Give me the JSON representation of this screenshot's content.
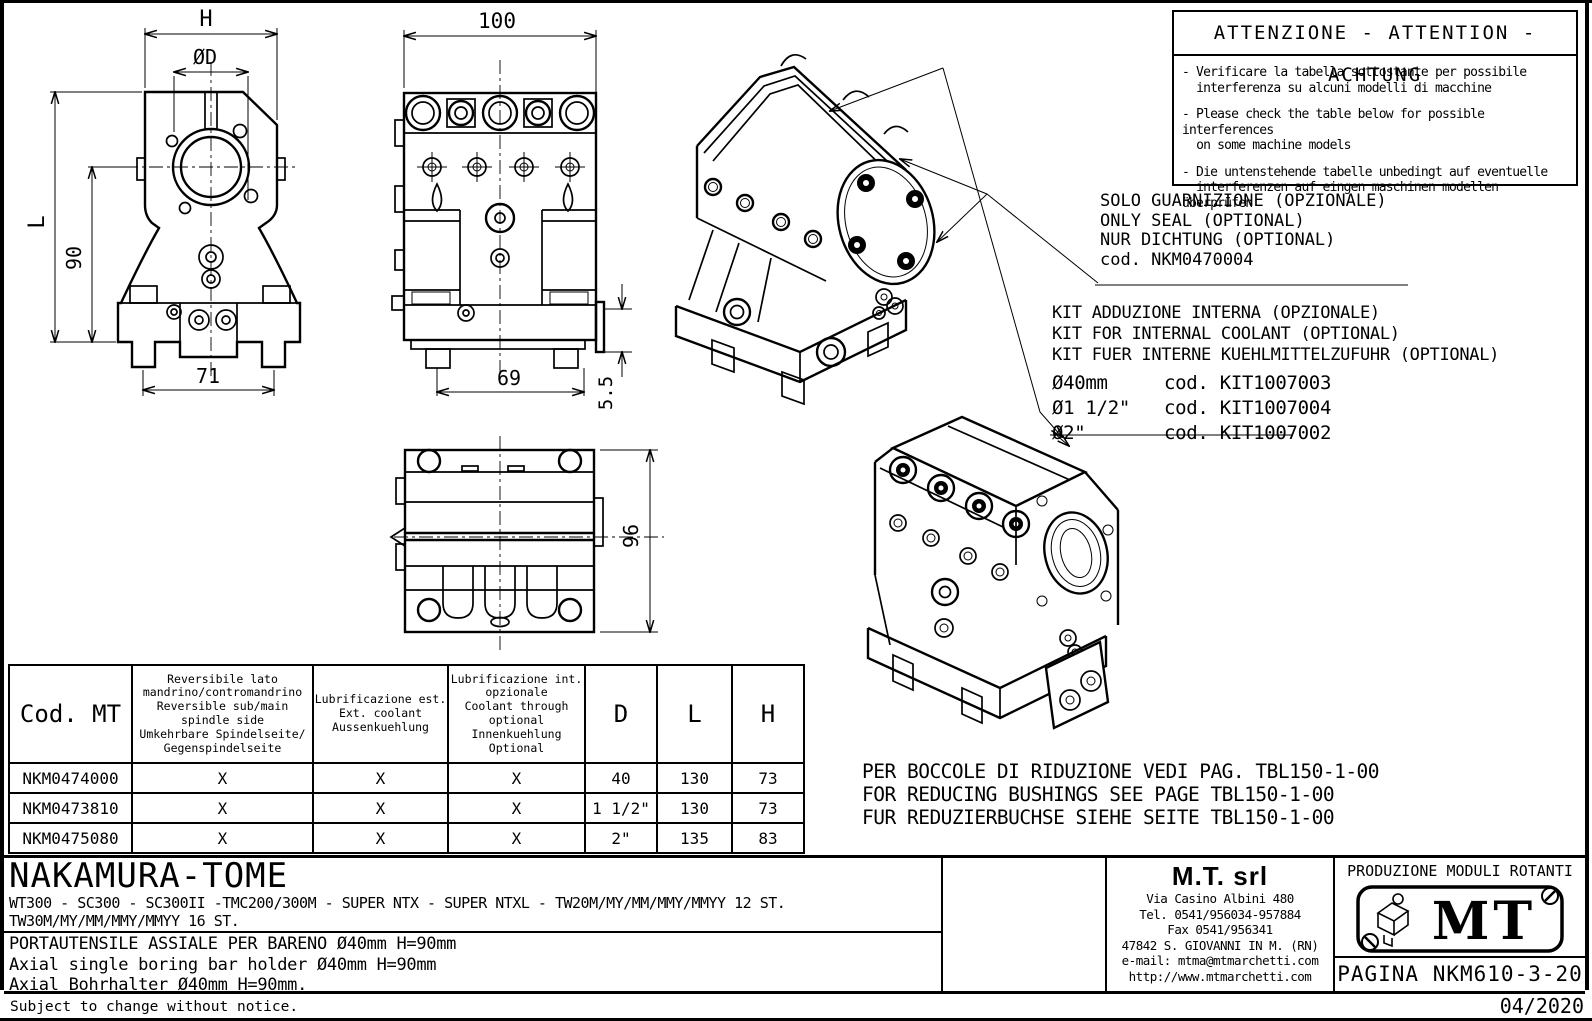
{
  "dims": {
    "front_h": "H",
    "front_d": "ØD",
    "front_l": "L",
    "front_90": "90",
    "front_71": "71",
    "side_100": "100",
    "side_69": "69",
    "side_55": "5.5",
    "top_96": "96"
  },
  "attention": {
    "title": "ATTENZIONE - ATTENTION - ACHTUNG",
    "items": [
      "- Verificare la tabella sottostante per possibile\n  interferenza su alcuni modelli di macchine",
      "- Please check the table below for possible interferences\n  on some machine models",
      "- Die untenstehende tabelle unbedingt auf eventuelle\n  interferenzen auf eingen maschinen modellen überprüfen"
    ]
  },
  "seal_note": {
    "line1": "SOLO GUARNIZIONE (OPZIONALE)",
    "line2": "ONLY SEAL (OPTIONAL)",
    "line3": "NUR DICHTUNG (OPTIONAL)",
    "code": "cod. NKM0470004"
  },
  "kit_note": {
    "line1": "KIT ADDUZIONE INTERNA (OPZIONALE)",
    "line2": "KIT FOR INTERNAL COOLANT (OPTIONAL)",
    "line3": "KIT FUER INTERNE KUEHLMITTELZUFUHR (OPTIONAL)",
    "options": [
      {
        "size": "Ø40mm",
        "code": "cod. KIT1007003"
      },
      {
        "size": "Ø1 1/2\"",
        "code": "cod. KIT1007004"
      },
      {
        "size": "Ø2\"",
        "code": "cod. KIT1007002"
      }
    ]
  },
  "bushings_note": {
    "line1": "PER BOCCOLE DI RIDUZIONE VEDI PAG. TBL150-1-00",
    "line2": "FOR REDUCING BUSHINGS SEE PAGE TBL150-1-00",
    "line3": "FUR REDUZIERBUCHSE SIEHE SEITE TBL150-1-00"
  },
  "table": {
    "headers": {
      "code": "Cod. MT",
      "reversible": "Reversibile lato\nmandrino/contromandrino\nReversible sub/main\nspindle side\nUmkehrbare Spindelseite/\nGegenspindelseite",
      "ext_coolant": "Lubrificazione est.\nExt. coolant\nAussenkuehlung",
      "int_coolant": "Lubrificazione int.\nopzionale\nCoolant through\noptional\nInnenkuehlung\nOptional",
      "d": "D",
      "l": "L",
      "h": "H"
    },
    "rows": [
      {
        "code": "NKM0474000",
        "rev": "X",
        "ext": "X",
        "int": "X",
        "d": "40",
        "l": "130",
        "h": "73"
      },
      {
        "code": "NKM0473810",
        "rev": "X",
        "ext": "X",
        "int": "X",
        "d": "1 1/2\"",
        "l": "130",
        "h": "73"
      },
      {
        "code": "NKM0475080",
        "rev": "X",
        "ext": "X",
        "int": "X",
        "d": "2\"",
        "l": "135",
        "h": "83"
      }
    ]
  },
  "title_block": {
    "brand": "NAKAMURA-TOME",
    "models_line1": "WT300 - SC300 - SC300II -TMC200/300M - SUPER NTX - SUPER NTXL - TW20M/MY/MM/MMY/MMYY 12 ST.",
    "models_line2": "TW30M/MY/MM/MMY/MMYY 16 ST.",
    "desc_it": "PORTAUTENSILE ASSIALE PER BARENO Ø40mm H=90mm",
    "desc_en": "Axial single boring bar holder Ø40mm H=90mm",
    "desc_de": "Axial Bohrhalter Ø40mm H=90mm.",
    "company": "M.T. srl",
    "address1": "Via Casino Albini 480",
    "address2": "Tel. 0541/956034-957884",
    "address3": "Fax 0541/956341",
    "address4": "47842 S. GIOVANNI IN M. (RN)",
    "address5": "e-mail: mtma@mtmarchetti.com",
    "address6": "http://www.mtmarchetti.com",
    "production": "PRODUZIONE MODULI ROTANTI",
    "logo_text": "MT",
    "page_label": "PAGINA NKM610-3-20"
  },
  "footer": {
    "note": "Subject to change without notice.",
    "date": "04/2020"
  }
}
